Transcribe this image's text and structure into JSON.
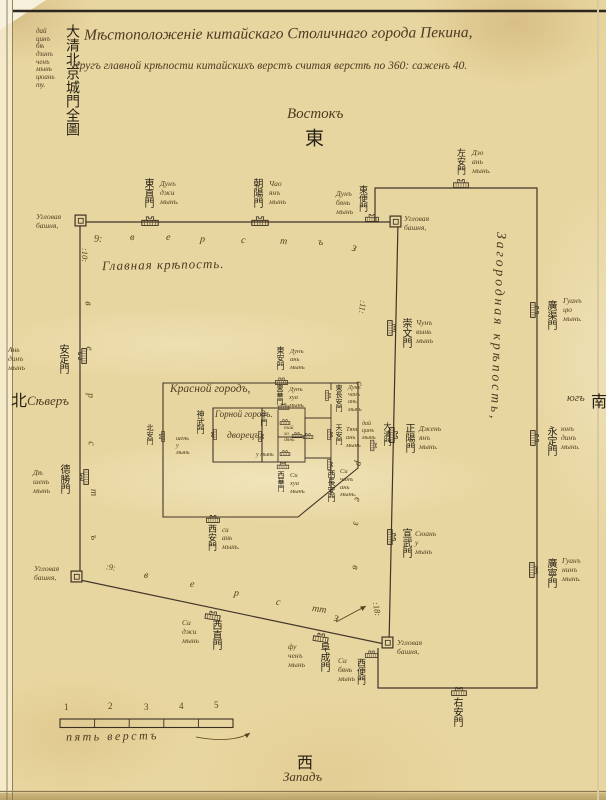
{
  "header": {
    "title_line1": "Мѣстоположенiе китайскаго Столичнаго города Пекина,",
    "title_line2": "Кругъ главной крѣпости китайскихъ верстъ считая верстѣ по 360: саженъ 40.",
    "margin_chinese": "大清北京城門全圖",
    "margin_translit": [
      "дай",
      "цинъ",
      "бѣ",
      "дзинъ",
      "ченъ",
      "мынь",
      "цюань",
      "ту."
    ]
  },
  "compass": {
    "east_ru": "Востокъ",
    "east_zh": "東",
    "north_ru": "Сѣверъ",
    "north_zh": "北",
    "south_ru": "югъ",
    "south_zh": "南",
    "west_ru": "Западъ",
    "west_zh": "西"
  },
  "regions": {
    "main_city": "Главная крѣпость.",
    "imperial_city": "Красной городъ,",
    "palace_line1": "Горной городъ.",
    "palace_line2": "дворецъ.",
    "outer_city": "Загородная крѣпость,",
    "hall": "тай\nхо\nдянь"
  },
  "labels": {
    "corner_tower": "Угловая\nбашня,"
  },
  "gates": [
    {
      "name": "dongzhimen",
      "zh": "東直門",
      "ru": "Дунъ\nджи\nмынь."
    },
    {
      "name": "chaoyangmen",
      "zh": "朝陽門",
      "ru": "Чао\nянъ\nмынь"
    },
    {
      "name": "dongbianmen",
      "zh": "東便門",
      "ru": "Дунъ\nбянь\nмынь"
    },
    {
      "name": "zuoanmen",
      "zh": "左安門",
      "ru": "Дзо\nань\nмынь."
    },
    {
      "name": "guangqumen",
      "zh": "廣渠門",
      "ru": "Гуанъ\nцю\nмынь."
    },
    {
      "name": "yongdingmen",
      "zh": "永定門",
      "ru": "юнъ\nдинъ\nмынь."
    },
    {
      "name": "guangningmen",
      "zh": "廣寧門",
      "ru": "Гуанъ\nнинъ\nмынь."
    },
    {
      "name": "youanmen",
      "zh": "右安門",
      "ru": ""
    },
    {
      "name": "xibianmen",
      "zh": "西便門",
      "ru": "Си\nбянь\nмынь"
    },
    {
      "name": "andingmen",
      "zh": "安定門",
      "ru": "Ань\nдинъ\nмынь"
    },
    {
      "name": "deshengmen",
      "zh": "德勝門",
      "ru": "Дѣ\nшень\nмынь"
    },
    {
      "name": "xizhimen",
      "zh": "西直門",
      "ru": "Си\nджи\nмынь"
    },
    {
      "name": "fuchengmen",
      "zh": "阜成門",
      "ru": "фу\nченъ\nмынь"
    },
    {
      "name": "chongwenmen",
      "zh": "崇文門",
      "ru": "Чунъ\nвынь\nмынь"
    },
    {
      "name": "zhengyangmen",
      "zh": "正陽門",
      "ru": "Джень\nянъ\nмынь."
    },
    {
      "name": "daqingmen",
      "zh": "大清門",
      "ru": "дай\nцинъ\nмынь"
    },
    {
      "name": "xuanwumen",
      "zh": "宣武門",
      "ru": "Сюань\nу\nмынь"
    },
    {
      "name": "donganmen",
      "zh": "東安門",
      "ru": "Дунъ\nань\nмынь"
    },
    {
      "name": "donghuamen",
      "zh": "東華門",
      "ru": "Дунъ\nхуа\nмынь"
    },
    {
      "name": "dongchanganmen",
      "zh": "東長安門",
      "ru": "Дунъ\nчанъ\nань\nмынь"
    },
    {
      "name": "tiananmen",
      "zh": "天安門",
      "ru": "Тянь\nань\nмынь"
    },
    {
      "name": "xichanganmen",
      "zh": "西長安門",
      "ru": "Си\nчанъ\nань\nмынь."
    },
    {
      "name": "xihuamen",
      "zh": "西華門",
      "ru": "Си\nхуа\nмынь"
    },
    {
      "name": "xianmen",
      "zh": "西安門",
      "ru": "си\nань\nмынь."
    },
    {
      "name": "beianmen",
      "zh": "北安門",
      "ru": ""
    },
    {
      "name": "shenwumen",
      "zh": "神武門",
      "ru": "шень\nу\nмынь"
    },
    {
      "name": "wumen",
      "zh": "午門",
      "ru": "у мынь"
    }
  ],
  "wall_marks": {
    "top": [
      "9:",
      "в",
      "е",
      "р",
      "с",
      "т",
      "ъ",
      "з"
    ],
    "left": [
      ":10:",
      "в",
      "е",
      "р",
      "с",
      "т",
      "ъ"
    ],
    "right": [
      ":11:",
      "с",
      "р",
      "е",
      "з",
      "в"
    ],
    "bottom": [
      ":9:",
      "в",
      "е",
      "р",
      "с",
      "тт",
      "з",
      ":18:"
    ]
  },
  "scale_bar": {
    "numbers": [
      "1",
      "2",
      "3",
      "4",
      "5"
    ],
    "caption": "пять верстъ"
  },
  "icons": {
    "gate_tower": "city-gate-tower",
    "corner_tower": "corner-watchtower"
  }
}
